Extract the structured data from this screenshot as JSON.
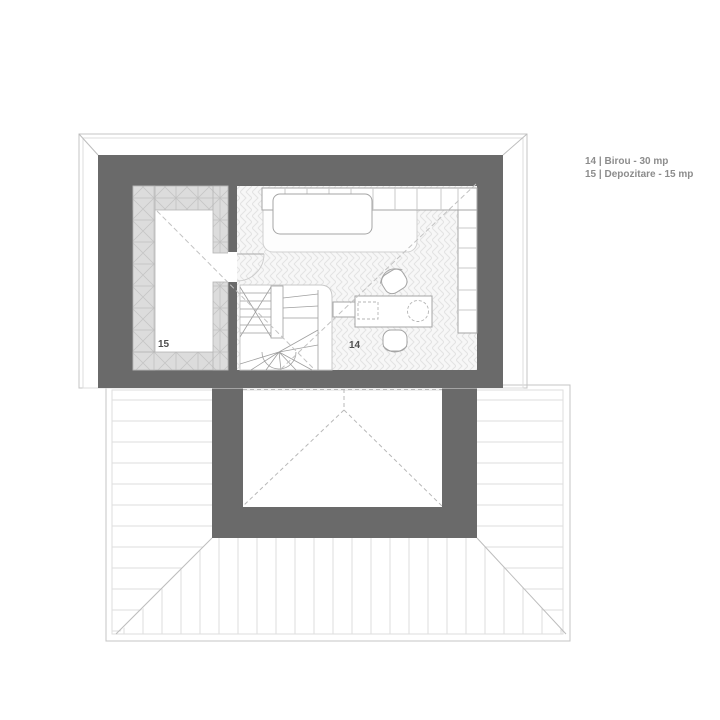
{
  "legend": {
    "items": [
      "14 | Birou - 30 mp",
      "15 | Depozitare - 15 mp"
    ]
  },
  "room_labels": {
    "birou": "14",
    "depozitare": "15"
  },
  "rooms": [
    {
      "number": "14",
      "name": "Birou",
      "area": "30 mp"
    },
    {
      "number": "15",
      "name": "Depozitare",
      "area": "15 mp"
    }
  ],
  "colors": {
    "wall": "#6a6a6a",
    "hatch-fill": "#dcdcdc",
    "hatch-line": "#c2c2c2",
    "floor-line": "#e3e3e3",
    "roof-line": "#dedede",
    "dash-line": "#c2c2c2",
    "label-text": "#4f4f4f",
    "legend-text": "#8c8c8c",
    "paper": "#ffffff"
  }
}
